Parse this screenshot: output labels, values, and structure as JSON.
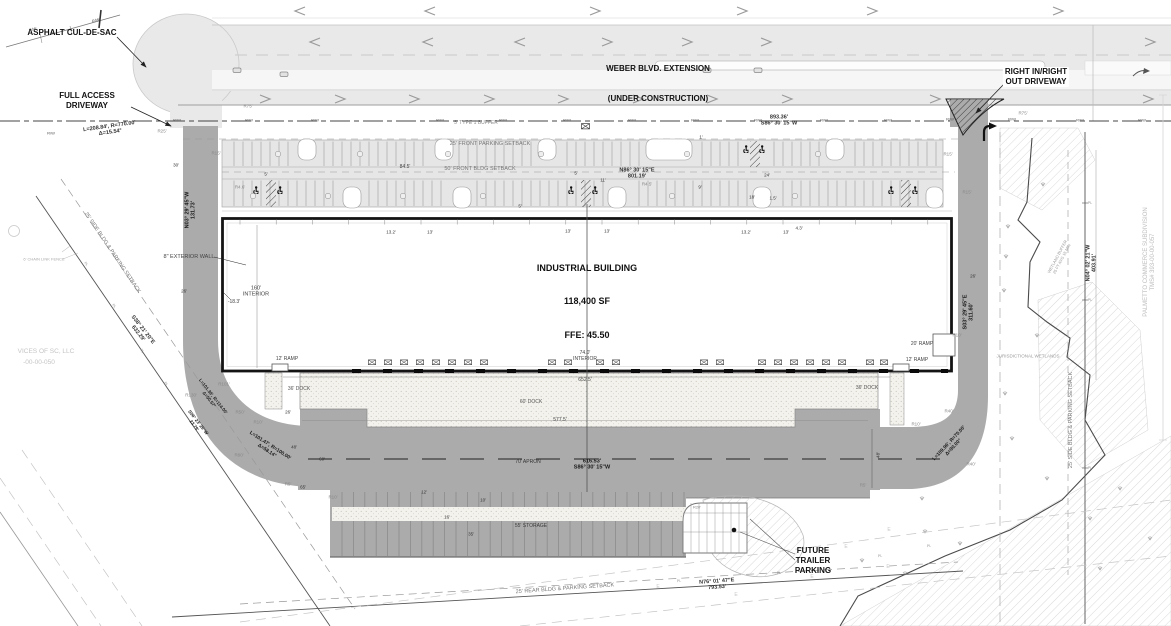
{
  "title": "Industrial Building Site Plan",
  "colors": {
    "pavement": "#ababab",
    "road_light": "#e9e9e9",
    "parking": "#e6e6e6",
    "concrete_stipple": "#f3f2ed",
    "line": "#222222",
    "adjacent_text": "#c4c4c4"
  },
  "callouts": {
    "cul_de_sac": "ASPHALT CUL-DE-SAC",
    "full_access": "FULL ACCESS\nDRIVEWAY",
    "weber_l1": "WEBER BLVD. EXTENSION",
    "weber_l2": "(UNDER CONSTRUCTION)",
    "right_in_out": "RIGHT IN/RIGHT\nOUT DRIVEWAY",
    "building_l1": "INDUSTRIAL BUILDING",
    "building_l2": "118,400 SF",
    "building_l3": "FFE: 45.50",
    "future_trailer": "FUTURE\nTRAILER\nPARKING"
  },
  "annotations": [
    {
      "t": "893.36'\nS86° 30' 15\"W",
      "x": 779,
      "y": 121,
      "w": 700,
      "s": 5.5
    },
    {
      "t": "N86° 30' 15\"E\n801.19'",
      "x": 637,
      "y": 174,
      "w": 700,
      "s": 5.5
    },
    {
      "t": "616.53'\nS86° 30' 15\"W",
      "x": 592,
      "y": 465,
      "w": 700,
      "s": 5.5,
      "c": "#1a1a1a"
    },
    {
      "t": "N76° 01' 47\"E\n793.53'",
      "x": 717,
      "y": 585,
      "r": -4,
      "w": 700,
      "s": 5.5
    },
    {
      "t": "S38° 21' 20\"E\n632.29'",
      "x": 140,
      "y": 332,
      "r": 52,
      "w": 700,
      "s": 5.5
    },
    {
      "t": "N03° 29' 45\"W\n131.73'",
      "x": 191,
      "y": 210,
      "r": -90,
      "w": 700,
      "s": 5.5,
      "c": "#1a1a1a"
    },
    {
      "t": "S03° 29' 45\"E\n311.60'",
      "x": 969,
      "y": 312,
      "r": -90,
      "w": 700,
      "s": 5.5,
      "c": "#1a1a1a"
    },
    {
      "t": "N04° 02' 21\"W\n403.91'",
      "x": 1092,
      "y": 263,
      "r": -90,
      "w": 700,
      "s": 5.5
    },
    {
      "t": "L=208.84', R=770.00'\nΔ=15.54°",
      "x": 110,
      "y": 130,
      "r": -8,
      "w": 700,
      "s": 5.5
    },
    {
      "t": "L=101.47', R=100.00'\nΔ=58.14°",
      "x": 268,
      "y": 449,
      "r": 33,
      "w": 700,
      "s": 5,
      "c": "#1a1a1a"
    },
    {
      "t": "L=101.39', R=114.00'\nΔ=50.57°",
      "x": 211,
      "y": 398,
      "r": 52,
      "w": 700,
      "s": 4.5,
      "c": "#1a1a1a"
    },
    {
      "t": "S06° 23' 25\"W\n23.79'",
      "x": 196,
      "y": 424,
      "r": 52,
      "w": 700,
      "s": 4.5,
      "c": "#1a1a1a"
    },
    {
      "t": "L=109.96', R=70.00'\nΔ=90.00°",
      "x": 952,
      "y": 446,
      "r": -47,
      "w": 700,
      "s": 5,
      "c": "#1a1a1a"
    },
    {
      "t": "25' FRONT PARKING SETBACK",
      "x": 490,
      "y": 144,
      "s": 5.5,
      "c": "#777"
    },
    {
      "t": "50' FRONT BLDG SETBACK",
      "x": 480,
      "y": 169,
      "s": 5.5,
      "c": "#777"
    },
    {
      "t": "84.5'",
      "x": 405,
      "y": 168,
      "s": 5,
      "c": "#444"
    },
    {
      "t": "5' TYPE 1 BUFFER",
      "x": 476,
      "y": 124,
      "s": 5,
      "c": "#888"
    },
    {
      "t": "25' SIDE BLDG & PARKING SETBACK",
      "x": 112,
      "y": 253,
      "r": 56,
      "s": 5.5,
      "c": "#777"
    },
    {
      "t": "25' REAR BLDG & PARKING SETBACK",
      "x": 565,
      "y": 589,
      "r": -4,
      "s": 5.5,
      "c": "#777"
    },
    {
      "t": "25' SIDE BLDG & PARKING SETBACK",
      "x": 1071,
      "y": 420,
      "r": -90,
      "s": 5.5,
      "c": "#777"
    },
    {
      "t": "JURISDICTIONAL WETLANDS",
      "x": 1028,
      "y": 356,
      "s": 4.5,
      "c": "#9a9a9a"
    },
    {
      "t": "WETLAND BUFFER\n25 FT AVG 15 MIN",
      "x": 1060,
      "y": 258,
      "r": -62,
      "s": 4,
      "c": "#9a9a9a"
    },
    {
      "t": "PALMETTO COMMERCE SUBDIVISION\nTMS# 393-00-00-057",
      "x": 1150,
      "y": 262,
      "r": -90,
      "s": 6,
      "c": "#bdbdbd"
    },
    {
      "t": "VICES OF SC, LLC",
      "x": 46,
      "y": 352,
      "s": 6.5,
      "c": "#c4c4c4"
    },
    {
      "t": "-00-00-050",
      "x": 39,
      "y": 363,
      "s": 6.5,
      "c": "#c4c4c4"
    },
    {
      "t": "6' CHAIN LINK FENCE",
      "x": 44,
      "y": 260,
      "s": 4,
      "c": "#aaa"
    },
    {
      "t": "8\" EXTERIOR WALL",
      "x": 189,
      "y": 257,
      "s": 5.5,
      "c": "#444"
    },
    {
      "t": "160'\nINTERIOR",
      "x": 256,
      "y": 292,
      "s": 5.5,
      "c": "#444"
    },
    {
      "t": "-18.3'",
      "x": 234,
      "y": 303,
      "s": 5,
      "c": "#444"
    },
    {
      "t": "74.0'\nINTERIOR",
      "x": 585,
      "y": 357,
      "s": 5,
      "c": "#444"
    },
    {
      "t": "652.5'",
      "x": 585,
      "y": 381,
      "s": 5,
      "c": "#444"
    },
    {
      "t": "577.5'",
      "x": 560,
      "y": 421,
      "s": 5,
      "c": "#444"
    },
    {
      "t": "60' DOCK",
      "x": 531,
      "y": 403,
      "s": 5,
      "c": "#555"
    },
    {
      "t": "36' DOCK",
      "x": 299,
      "y": 390,
      "s": 5,
      "c": "#555"
    },
    {
      "t": "36' DOCK",
      "x": 867,
      "y": 389,
      "s": 5,
      "c": "#555"
    },
    {
      "t": "12' RAMP",
      "x": 287,
      "y": 360,
      "s": 5,
      "c": "#444"
    },
    {
      "t": "12' RAMP",
      "x": 917,
      "y": 361,
      "s": 5,
      "c": "#444"
    },
    {
      "t": "20' RAMP",
      "x": 922,
      "y": 345,
      "s": 5,
      "c": "#444"
    },
    {
      "t": "70' APRON",
      "x": 528,
      "y": 463,
      "s": 5,
      "c": "#333"
    },
    {
      "t": "55' STORAGE",
      "x": 531,
      "y": 527,
      "s": 5,
      "c": "#3a3a3a"
    },
    {
      "t": "13.2'",
      "x": 391,
      "y": 232,
      "s": 4.5
    },
    {
      "t": "13'",
      "x": 430,
      "y": 232,
      "s": 4.5
    },
    {
      "t": "5'",
      "x": 520,
      "y": 206,
      "s": 4.5
    },
    {
      "t": "13'",
      "x": 568,
      "y": 231,
      "s": 4.5
    },
    {
      "t": "13'",
      "x": 607,
      "y": 231,
      "s": 4.5
    },
    {
      "t": "13.2'",
      "x": 746,
      "y": 232,
      "s": 4.5
    },
    {
      "t": "13'",
      "x": 786,
      "y": 232,
      "s": 4.5
    },
    {
      "t": "4.3'",
      "x": 799,
      "y": 228,
      "s": 4.5
    },
    {
      "t": "9'",
      "x": 700,
      "y": 187,
      "s": 4.5
    },
    {
      "t": "24'",
      "x": 767,
      "y": 175,
      "s": 4.5
    },
    {
      "t": "18'",
      "x": 752,
      "y": 197,
      "s": 4.5
    },
    {
      "t": "1.5'",
      "x": 773,
      "y": 198,
      "s": 4.5
    },
    {
      "t": "5'",
      "x": 576,
      "y": 173,
      "s": 4.5
    },
    {
      "t": "5'",
      "x": 266,
      "y": 174,
      "s": 4.5
    },
    {
      "t": "11'",
      "x": 603,
      "y": 180,
      "s": 4.5
    },
    {
      "t": "1'",
      "x": 701,
      "y": 137,
      "s": 4.5
    },
    {
      "t": "R4.5'",
      "x": 647,
      "y": 184,
      "s": 4.5,
      "c": "#888"
    },
    {
      "t": "R4.6'",
      "x": 240,
      "y": 187,
      "s": 4.5,
      "c": "#888"
    },
    {
      "t": "R15'",
      "x": 216,
      "y": 153,
      "s": 4.5,
      "c": "#888"
    },
    {
      "t": "R75'",
      "x": 248,
      "y": 106,
      "s": 4.5,
      "c": "#888"
    },
    {
      "t": "R25'",
      "x": 162,
      "y": 131,
      "s": 4.5,
      "c": "#888"
    },
    {
      "t": "R75'",
      "x": 1023,
      "y": 113,
      "s": 4.5,
      "c": "#888"
    },
    {
      "t": "R15'",
      "x": 948,
      "y": 154,
      "s": 4.5,
      "c": "#888"
    },
    {
      "t": "R15'",
      "x": 967,
      "y": 192,
      "s": 4.5,
      "c": "#888"
    },
    {
      "t": "R101'",
      "x": 224,
      "y": 384,
      "s": 4.5,
      "c": "#888"
    },
    {
      "t": "R130'",
      "x": 191,
      "y": 395,
      "s": 4.5,
      "c": "#888"
    },
    {
      "t": "R50'",
      "x": 240,
      "y": 412,
      "s": 4.5,
      "c": "#888"
    },
    {
      "t": "R10'",
      "x": 258,
      "y": 422,
      "s": 4.5,
      "c": "#888"
    },
    {
      "t": "R80'",
      "x": 239,
      "y": 455,
      "s": 4.5,
      "c": "#888"
    },
    {
      "t": "R5'",
      "x": 288,
      "y": 484,
      "s": 4.5,
      "c": "#888"
    },
    {
      "t": "65'",
      "x": 303,
      "y": 487,
      "s": 4.5
    },
    {
      "t": "60'",
      "x": 322,
      "y": 459,
      "s": 4.5
    },
    {
      "t": "48'",
      "x": 294,
      "y": 447,
      "s": 4.5
    },
    {
      "t": "26'",
      "x": 288,
      "y": 412,
      "s": 4.5
    },
    {
      "t": "26'",
      "x": 184,
      "y": 291,
      "s": 4.5
    },
    {
      "t": "30'",
      "x": 176,
      "y": 165,
      "s": 4.5
    },
    {
      "t": "R10'",
      "x": 333,
      "y": 497,
      "s": 4.5,
      "c": "#888"
    },
    {
      "t": "12'",
      "x": 424,
      "y": 492,
      "s": 4.5
    },
    {
      "t": "10'",
      "x": 483,
      "y": 500,
      "s": 4.5
    },
    {
      "t": "35'",
      "x": 471,
      "y": 534,
      "s": 4.5
    },
    {
      "t": "16'",
      "x": 447,
      "y": 517,
      "s": 4.5
    },
    {
      "t": "26'",
      "x": 973,
      "y": 276,
      "s": 4.5
    },
    {
      "t": "R10'",
      "x": 957,
      "y": 335,
      "s": 4.5,
      "c": "#888"
    },
    {
      "t": "R40'",
      "x": 949,
      "y": 411,
      "s": 4.5,
      "c": "#888"
    },
    {
      "t": "R10'",
      "x": 916,
      "y": 424,
      "s": 4.5,
      "c": "#888"
    },
    {
      "t": "R40'",
      "x": 971,
      "y": 464,
      "s": 4.5,
      "c": "#888"
    },
    {
      "t": "48'",
      "x": 878,
      "y": 455,
      "r": -90,
      "s": 4.5
    },
    {
      "t": "R20'",
      "x": 697,
      "y": 508,
      "s": 4,
      "c": "#888"
    },
    {
      "t": "R5'",
      "x": 863,
      "y": 485,
      "s": 4.5,
      "c": "#888"
    },
    {
      "t": "R/W",
      "x": 51,
      "y": 134,
      "s": 4,
      "c": "#555"
    },
    {
      "t": "R/W",
      "x": 33,
      "y": 30,
      "r": -16,
      "s": 4,
      "c": "#555"
    },
    {
      "t": "R/W",
      "x": 96,
      "y": 21,
      "r": -16,
      "s": 4,
      "c": "#555"
    },
    {
      "t": "R/W",
      "x": 177,
      "y": 121,
      "s": 4,
      "c": "#555"
    },
    {
      "t": "R/W",
      "x": 249,
      "y": 121,
      "s": 4,
      "c": "#555"
    },
    {
      "t": "R/W",
      "x": 315,
      "y": 121,
      "s": 4,
      "c": "#555"
    },
    {
      "t": "R/W",
      "x": 440,
      "y": 121,
      "s": 4,
      "c": "#555"
    },
    {
      "t": "R/W",
      "x": 503,
      "y": 121,
      "s": 4,
      "c": "#555"
    },
    {
      "t": "R/W",
      "x": 567,
      "y": 121,
      "s": 4,
      "c": "#555"
    },
    {
      "t": "R/W",
      "x": 632,
      "y": 121,
      "s": 4,
      "c": "#555"
    },
    {
      "t": "R/W",
      "x": 695,
      "y": 121,
      "s": 4,
      "c": "#555"
    },
    {
      "t": "R/W",
      "x": 758,
      "y": 121,
      "s": 4,
      "c": "#555"
    },
    {
      "t": "R/W",
      "x": 824,
      "y": 121,
      "s": 4,
      "c": "#555"
    },
    {
      "t": "R/W",
      "x": 888,
      "y": 121,
      "s": 4,
      "c": "#555"
    },
    {
      "t": "R/W",
      "x": 950,
      "y": 120,
      "s": 4,
      "c": "#555"
    },
    {
      "t": "R/W",
      "x": 1012,
      "y": 120,
      "s": 4,
      "c": "#555"
    },
    {
      "t": "R/W",
      "x": 1080,
      "y": 121,
      "s": 4,
      "c": "#555"
    },
    {
      "t": "R/W",
      "x": 1142,
      "y": 121,
      "s": 4,
      "c": "#555"
    },
    {
      "t": "PL",
      "x": 86,
      "y": 264,
      "r": 52,
      "s": 3.5,
      "c": "#909090"
    },
    {
      "t": "PL",
      "x": 114,
      "y": 306,
      "r": 52,
      "s": 3.5,
      "c": "#909090"
    },
    {
      "t": "PL",
      "x": 142,
      "y": 351,
      "r": 52,
      "s": 3.5,
      "c": "#909090"
    },
    {
      "t": "PL",
      "x": 166,
      "y": 384,
      "r": 52,
      "s": 3.5,
      "c": "#909090"
    },
    {
      "t": "PL",
      "x": 679,
      "y": 581,
      "r": -4,
      "s": 3.5,
      "c": "#909090"
    },
    {
      "t": "PL",
      "x": 779,
      "y": 573,
      "r": -4,
      "s": 3.5,
      "c": "#909090"
    },
    {
      "t": "PL",
      "x": 880,
      "y": 556,
      "r": -4,
      "s": 3.5,
      "c": "#909090"
    },
    {
      "t": "PL",
      "x": 929,
      "y": 546,
      "r": -4,
      "s": 3.5,
      "c": "#909090"
    },
    {
      "t": "PL",
      "x": 1090,
      "y": 203,
      "s": 3.5,
      "c": "#909090"
    },
    {
      "t": "PL",
      "x": 1090,
      "y": 300,
      "s": 3.5,
      "c": "#909090"
    },
    {
      "t": "PL",
      "x": 1090,
      "y": 468,
      "s": 3.5,
      "c": "#909090"
    },
    {
      "t": "E",
      "x": 658,
      "y": 588,
      "s": 5,
      "c": "#c6c6c6"
    },
    {
      "t": "E",
      "x": 736,
      "y": 596,
      "s": 5,
      "c": "#c6c6c6"
    },
    {
      "t": "E",
      "x": 812,
      "y": 578,
      "s": 5,
      "c": "#c6c6c6"
    },
    {
      "t": "E",
      "x": 846,
      "y": 548,
      "s": 5,
      "c": "#c6c6c6"
    },
    {
      "t": "E",
      "x": 888,
      "y": 568,
      "s": 5,
      "c": "#c6c6c6"
    },
    {
      "t": "E",
      "x": 889,
      "y": 531,
      "s": 5,
      "c": "#c6c6c6"
    }
  ]
}
